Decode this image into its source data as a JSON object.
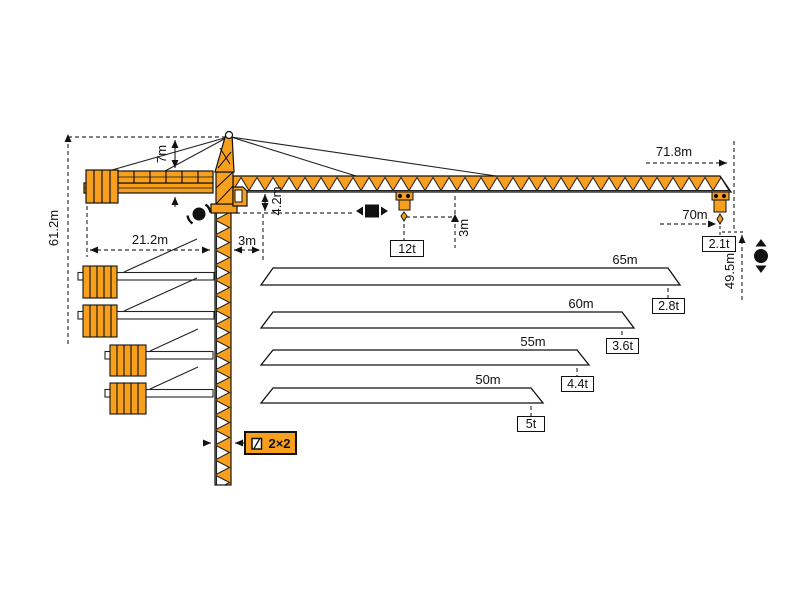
{
  "colors": {
    "crane_orange": "#F8A01E",
    "outline": "#1a1a1a",
    "dim_line": "#333333"
  },
  "dimensions": {
    "total_height": "61.2m",
    "apex_height": "7m",
    "counterjib_radius": "21.2m",
    "min_radius": "3m",
    "jib_section_height": "4.2m",
    "hook_drop": "3m",
    "max_jib_radius": "71.8m",
    "max_hook_radius": "70m",
    "hook_height": "49.5m",
    "mast_section": "2×2"
  },
  "loads": {
    "max_capacity": "12t",
    "tip_load_70m": "2.1t"
  },
  "jib_options": [
    {
      "length": "65m",
      "tip_load": "2.8t"
    },
    {
      "length": "60m",
      "tip_load": "3.6t"
    },
    {
      "length": "55m",
      "tip_load": "4.4t"
    },
    {
      "length": "50m",
      "tip_load": "5t"
    }
  ],
  "icons": {
    "slewing": "slewing-icon",
    "trolley_travel": "trolley-travel-icon",
    "hoist": "hoist-icon",
    "mast_section": "mast-section-icon"
  },
  "chart_data": {
    "type": "table",
    "title": "Tower crane working ranges and tip loads",
    "columns": [
      "jib_length_or_radius",
      "tip_load"
    ],
    "rows": [
      [
        "70m",
        "2.1t"
      ],
      [
        "65m",
        "2.8t"
      ],
      [
        "60m",
        "3.6t"
      ],
      [
        "55m",
        "4.4t"
      ],
      [
        "50m",
        "5t"
      ]
    ],
    "max_capacity": "12t",
    "hook_height": "49.5m",
    "total_height": "61.2m"
  }
}
